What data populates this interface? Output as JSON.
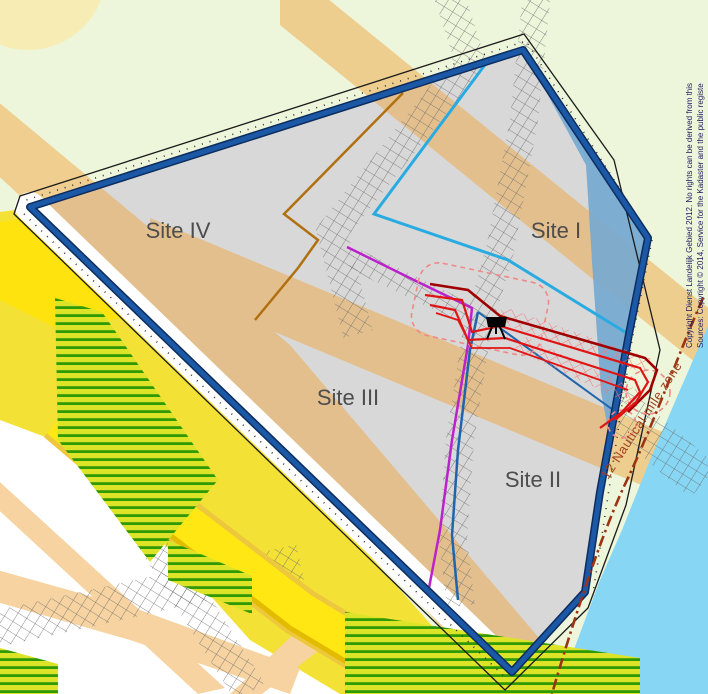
{
  "map": {
    "title": "Offshore wind site allocation map",
    "site_labels": [
      {
        "id": "site-iv",
        "label": "Site IV"
      },
      {
        "id": "site-i",
        "label": "Site I"
      },
      {
        "id": "site-iii",
        "label": "Site III"
      },
      {
        "id": "site-ii",
        "label": "Site II"
      }
    ],
    "boundary_label": "12 Nautical mile zone",
    "credits": {
      "line1": "Sources: Copyright © 2014, Service for the Kadaster and the public registe",
      "line2": "Copyright Dienst Landelijk Gebied 2012. No rights can be derived from this"
    },
    "icons": [
      {
        "name": "platform-marker-icon",
        "meaning": "installation / survey platform symbol"
      }
    ],
    "colors": {
      "land": "#edf5da",
      "sea": "#86d6f4",
      "site_fill": "#d8d8d8",
      "concession_border": "#1b59a6",
      "site1_line": "#29abe2",
      "site2_line": "#1f64ad",
      "site3_line": "#bb22cc",
      "site4_line": "#b07010",
      "cable_red": "#e01414",
      "cable_dark_red": "#a00000",
      "cable_pink": "#f08888",
      "nautical_line": "#9b3315",
      "corridor_grid": "#666666",
      "farmland_yellow": "#f3e135",
      "road_orange": "#f0a43c",
      "hatch_green": "#2f9a05"
    }
  }
}
